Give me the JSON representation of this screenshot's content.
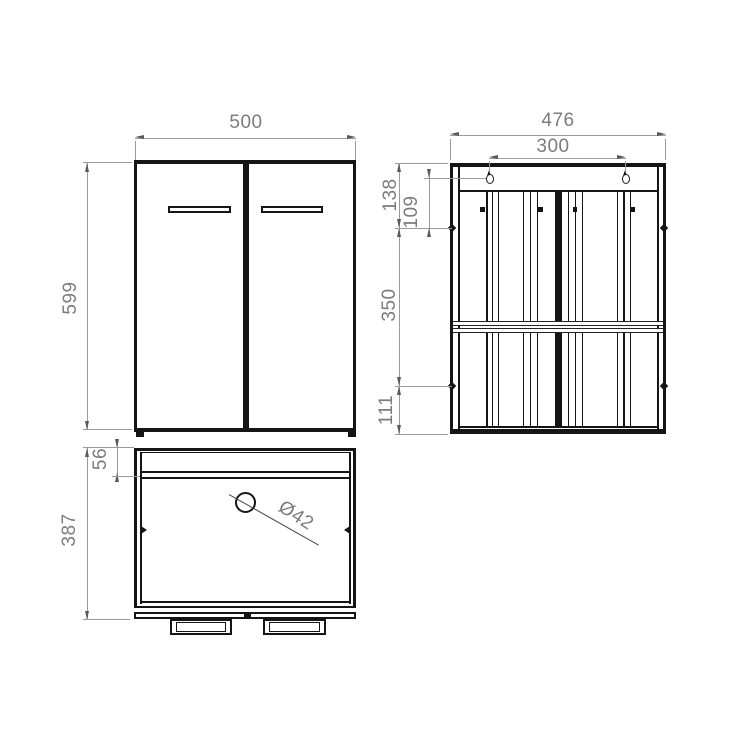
{
  "drawing": {
    "front_view": {
      "width": "500",
      "height": "599"
    },
    "plan_view": {
      "depth": "387",
      "front_rail": "56",
      "hole_diameter": "Ø42"
    },
    "back_view": {
      "width": "476",
      "keyhole_spacing": "300",
      "top_to_cam": "138",
      "keyhole_to_cam": "109",
      "cam_to_cam": "350",
      "cam_to_bottom": "111"
    }
  },
  "colors": {
    "outline": "#151515",
    "dimension_line": "#9b9b9b",
    "dimension_text": "#7c7c7c",
    "background": "#ffffff"
  }
}
